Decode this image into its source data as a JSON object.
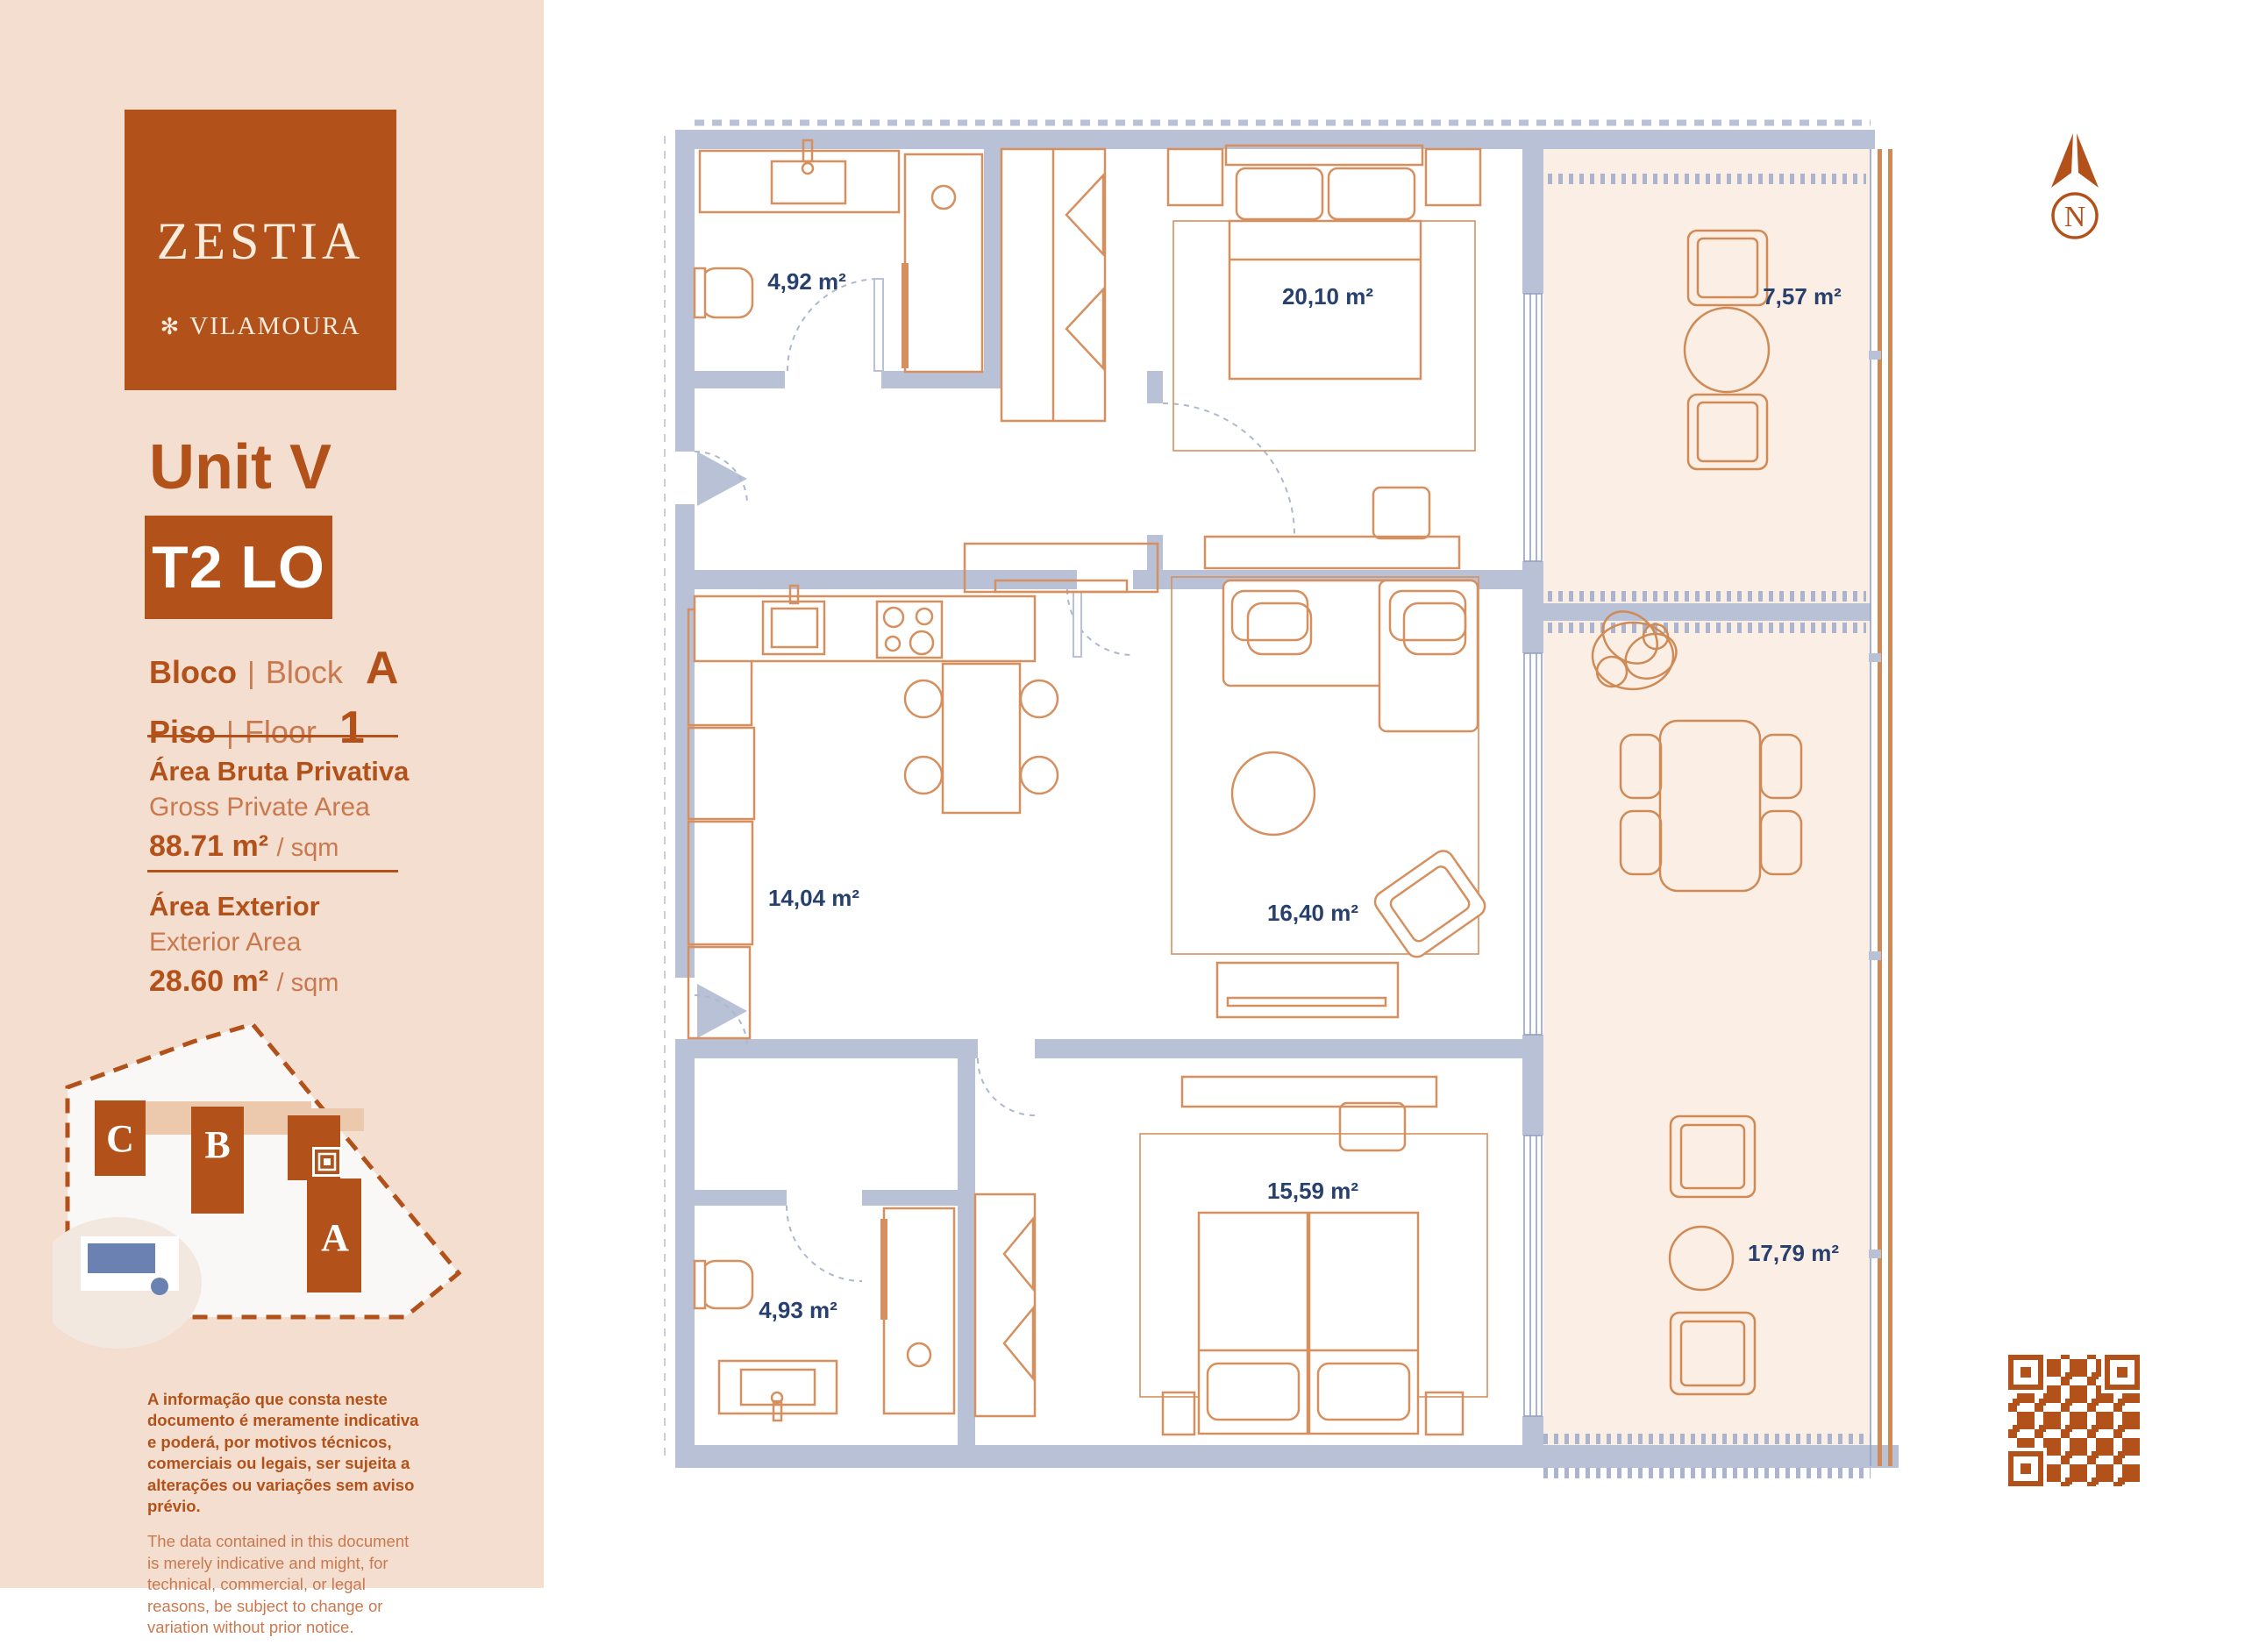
{
  "colors": {
    "brand": "#b2521a",
    "brand_light": "#c9794f",
    "wall": "#b9c1d7",
    "furniture": "#d6905f",
    "terrace": "#faeee5",
    "room_label": "#28406d",
    "pool": "#6a81b1",
    "sidebar_bg": "#f3ded0"
  },
  "brand": {
    "logo_title": "ZESTIA",
    "logo_mark": "✻",
    "logo_subtitle": "VILAMOURA"
  },
  "unit": {
    "title": "Unit V",
    "type_badge": "T2 LO",
    "block": {
      "label_pt": "Bloco",
      "sep": "|",
      "label_en": "Block",
      "value": "A"
    },
    "floor": {
      "label_pt": "Piso",
      "sep": "|",
      "label_en": "Floor",
      "value": "1"
    }
  },
  "areas": {
    "gross": {
      "label_pt": "Área Bruta Privativa",
      "label_en": "Gross Private Area",
      "value": "88.71 m²",
      "suffix": "/ sqm"
    },
    "exterior": {
      "label_pt": "Área Exterior",
      "label_en": "Exterior Area",
      "value": "28.60 m²",
      "suffix": "/ sqm"
    }
  },
  "site_map": {
    "blocks": [
      "C",
      "B",
      "A"
    ]
  },
  "disclaimer": {
    "pt": "A informação que consta neste documento é meramente indicativa e poderá, por motivos técnicos, comerciais ou legais, ser sujeita a alterações ou variações sem aviso prévio.",
    "en": "The data contained in this document is merely indicative and might, for technical, commercial, or legal reasons, be subject to change or variation without prior notice."
  },
  "floor_plan": {
    "compass": "N",
    "rooms": [
      {
        "name": "bathroom-1",
        "area": "4,92 m²"
      },
      {
        "name": "master-bedroom",
        "area": "20,10 m²"
      },
      {
        "name": "balcony",
        "area": "7,57 m²"
      },
      {
        "name": "kitchen-dining",
        "area": "14,04 m²"
      },
      {
        "name": "living-room",
        "area": "16,40 m²"
      },
      {
        "name": "bedroom-2",
        "area": "15,59 m²"
      },
      {
        "name": "terrace",
        "area": "17,79 m²"
      },
      {
        "name": "bathroom-2",
        "area": "4,93 m²"
      }
    ]
  }
}
